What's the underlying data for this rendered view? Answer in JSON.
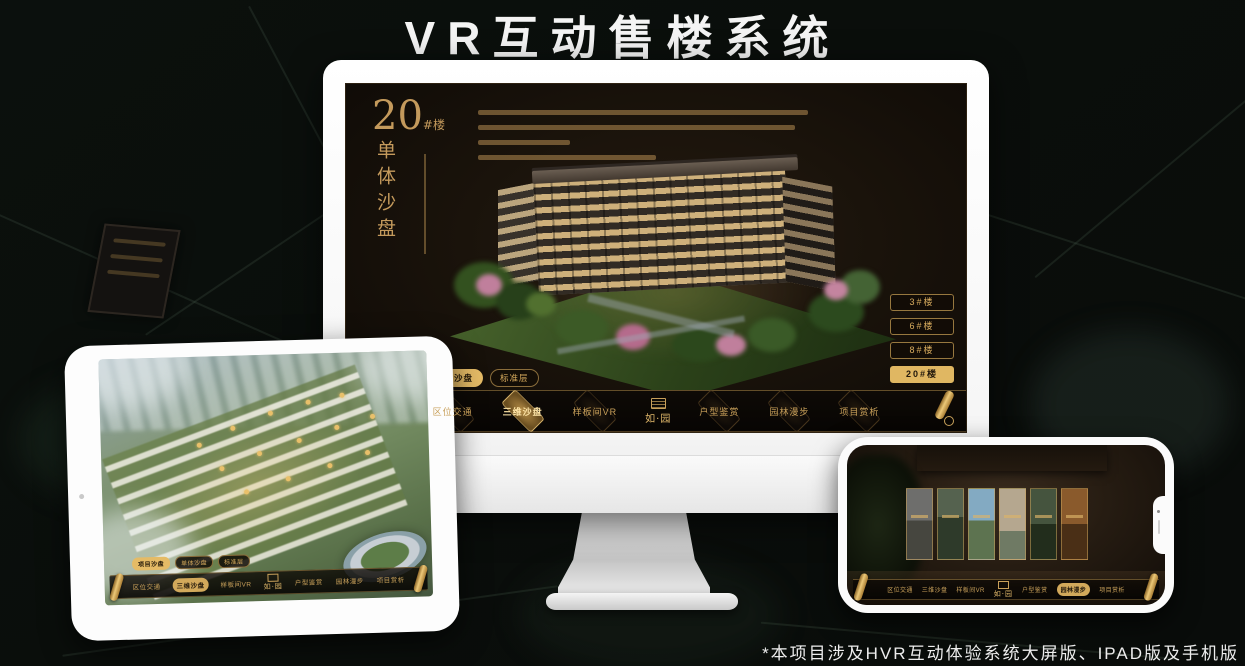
{
  "page": {
    "title": "VR互动售楼系统",
    "footnote": "*本项目涉及HVR互动体验系统大屏版、IPAD版及手机版"
  },
  "colors": {
    "gold_accent": "#d8b36a",
    "gold_active_bg": "#e5bb66",
    "screen_bg": "#1a130b",
    "title_color": "#f4f4f4"
  },
  "app": {
    "logo": "如·园",
    "tabs": [
      "项目沙盘",
      "单体沙盘",
      "标准层"
    ],
    "nav_items": [
      "区位交通",
      "三维沙盘",
      "样板间VR",
      "户型鉴赏",
      "园林漫步",
      "项目赏析"
    ]
  },
  "monitor": {
    "headline_no": "20",
    "headline_unit": "#楼",
    "headline_sub_vertical": "单体沙盘",
    "active_tab": "单体沙盘",
    "active_nav": "三维沙盘",
    "floor_buttons": [
      "3#楼",
      "6#楼",
      "8#楼",
      "20#楼"
    ],
    "active_floor": "20#楼"
  },
  "ipad": {
    "active_tab": "项目沙盘",
    "active_nav": "三维沙盘"
  },
  "phone": {
    "active_nav": "园林漫步",
    "gallery_panel_count": 6
  }
}
